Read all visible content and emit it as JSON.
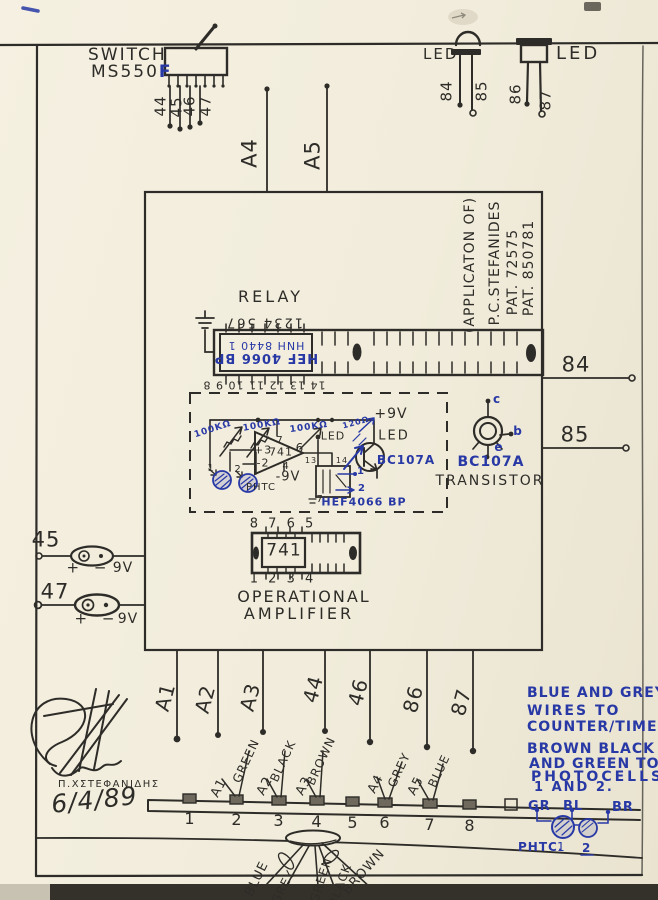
{
  "colors": {
    "ink": "#2e2c28",
    "blue": "#2839a6",
    "paper": "#f1ecdb"
  },
  "switch": {
    "label": "SWITCH",
    "model": "MS550",
    "model_suffix": "F",
    "pins": [
      "44",
      "45",
      "46",
      "47"
    ]
  },
  "top_leds": {
    "left_label": "LED",
    "right_label": "LED",
    "left_pins": [
      "84",
      "85"
    ],
    "right_pins": [
      "86",
      "87"
    ]
  },
  "top_wires": {
    "a4": "A4",
    "a5": "A5"
  },
  "relay": {
    "title": "RELAY",
    "pins_top": "1234  567",
    "chip_line1": "HEF 4066 BP",
    "chip_line2": "HNH 8440 1",
    "pins_bottom": "14 13 12 11 10 9 8"
  },
  "patent": {
    "line1": "(APPLICATON OF)",
    "line2": "P.C.STEFANIDES",
    "line3": "PAT. 72575",
    "line4": "PAT. 850781"
  },
  "circuit": {
    "pot1": "100KΩ",
    "pot2": "100KΩ",
    "feedback": "100KΩ",
    "res": "120Ω",
    "vplus": "+9V",
    "vminus": "-9V",
    "led_left": "LED",
    "led_right": "LED",
    "opamp": "741",
    "pin7": "7",
    "pin4": "4",
    "pin6": "6",
    "pin_plus": "+3",
    "pin_minus": "-2",
    "phtc": "PHTC",
    "pc1": "1",
    "pc2": "2",
    "transistor": "BC107A",
    "quad_switch": "HEF4066 BP",
    "pin13": "13",
    "pin14": "14",
    "pin_gnd": "7",
    "out1": "1",
    "out2": "2"
  },
  "transistor_detail": {
    "c": "c",
    "b": "b",
    "e": "e",
    "part": "BC107A",
    "caption": "TRANSISTOR"
  },
  "right_wires": {
    "w84": "84",
    "w85": "85"
  },
  "battery1": {
    "wire": "45",
    "polarity": "+ −",
    "voltage": "9V"
  },
  "battery2": {
    "wire": "47",
    "polarity": "+ −",
    "voltage": "9V"
  },
  "opamp_dip": {
    "pins_top": "8 7 6 5",
    "chip": "741",
    "pins_bottom": "1 2 3 4",
    "caption1": "OPERATIONAL",
    "caption2": "AMPLIFIER"
  },
  "bottom_wires": [
    "A1",
    "A2",
    "A3",
    "44",
    "46",
    "86",
    "87"
  ],
  "terminals": {
    "numbers": [
      "1",
      "2",
      "3",
      "4",
      "5",
      "6",
      "7",
      "8"
    ],
    "tag_a1": "A1",
    "tag_green": "GREEN",
    "tag_a2": "A2",
    "tag_black": "BLACK",
    "tag_a3": "A3",
    "tag_brown": "BROWN",
    "tag_a4": "A4",
    "tag_grey": "GREY",
    "tag_a5": "A5",
    "tag_blue": "BLUE"
  },
  "cable": {
    "w1": "BLUE",
    "w2": "GREY",
    "w3": "GREEN",
    "w4": "BLACK",
    "w5": "BROWN"
  },
  "notes": {
    "line1": "BLUE AND GREY",
    "line2": "WIRES TO",
    "line3": "COUNTER/TIMER.",
    "line4": "BROWN BLACK",
    "line5": "AND GREEN TO",
    "line6": "PHOTOCELLS",
    "line7": "1 AND 2.",
    "gr": "GR",
    "bl": "BL",
    "br": "BR",
    "phtc": "PHTC.",
    "pc1": "1",
    "pc2": "2"
  },
  "signature": {
    "name": "Π.ΧΣΤΕΦΑΝΙΔΗΣ",
    "date": "6/4/89"
  }
}
